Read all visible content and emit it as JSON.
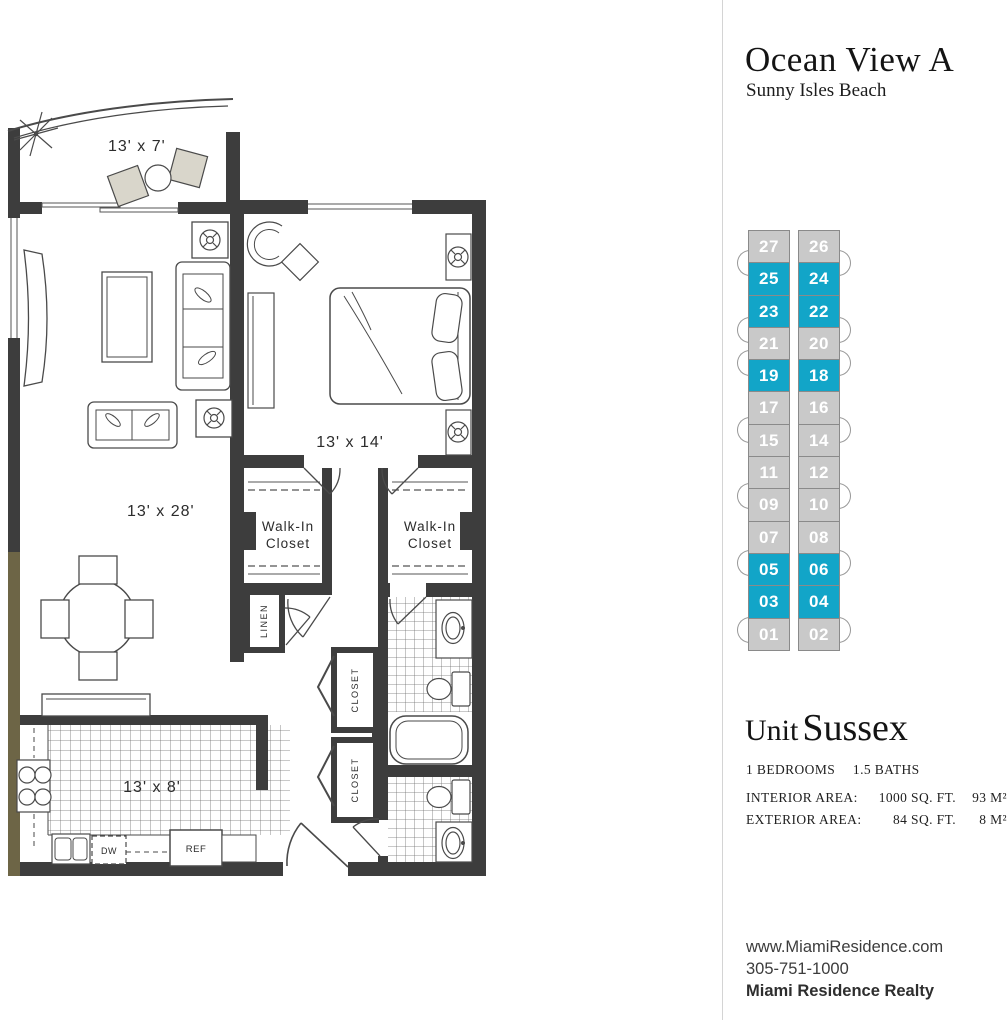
{
  "header": {
    "title": "Ocean View A",
    "subtitle": "Sunny Isles Beach"
  },
  "stack": {
    "left_column": [
      {
        "label": "27",
        "highlight": false
      },
      {
        "label": "25",
        "highlight": true
      },
      {
        "label": "23",
        "highlight": true
      },
      {
        "label": "21",
        "highlight": false
      },
      {
        "label": "19",
        "highlight": true
      },
      {
        "label": "17",
        "highlight": false
      },
      {
        "label": "15",
        "highlight": false
      },
      {
        "label": "11",
        "highlight": false
      },
      {
        "label": "09",
        "highlight": false
      },
      {
        "label": "07",
        "highlight": false
      },
      {
        "label": "05",
        "highlight": true
      },
      {
        "label": "03",
        "highlight": true
      },
      {
        "label": "01",
        "highlight": false
      }
    ],
    "right_column": [
      {
        "label": "26",
        "highlight": false
      },
      {
        "label": "24",
        "highlight": true
      },
      {
        "label": "22",
        "highlight": true
      },
      {
        "label": "20",
        "highlight": false
      },
      {
        "label": "18",
        "highlight": true
      },
      {
        "label": "16",
        "highlight": false
      },
      {
        "label": "14",
        "highlight": false
      },
      {
        "label": "12",
        "highlight": false
      },
      {
        "label": "10",
        "highlight": false
      },
      {
        "label": "08",
        "highlight": false
      },
      {
        "label": "06",
        "highlight": true
      },
      {
        "label": "04",
        "highlight": true
      },
      {
        "label": "02",
        "highlight": false
      }
    ],
    "balcony_tab_boundaries": [
      0,
      2,
      3,
      5,
      7,
      9,
      11
    ],
    "colors": {
      "highlight": "#12a5c8",
      "normal": "#c9c9c9",
      "text": "#ffffff",
      "border": "#8a8a8a"
    }
  },
  "unit": {
    "label": "Unit",
    "name": "Sussex",
    "bedrooms": "1 BEDROOMS",
    "baths": "1.5 BATHS",
    "interior_label": "INTERIOR AREA:",
    "interior_sqft": "1000 SQ. FT.",
    "interior_m2": "93 M²",
    "exterior_label": "EXTERIOR AREA:",
    "exterior_sqft": "84 SQ. FT.",
    "exterior_m2": "8 M²"
  },
  "floorplan": {
    "labels": {
      "balcony": "13' x 7'",
      "living": "13' x 28'",
      "bedroom": "13' x 14'",
      "kitchen": "13' x 8'",
      "walk_in_line1": "Walk-In",
      "walk_in_line2": "Closet",
      "linen": "LINEN",
      "closet": "CLOSET",
      "dishwasher": "DW",
      "refrigerator": "REF"
    }
  },
  "footer": {
    "website": "www.MiamiResidence.com",
    "phone": "305-751-1000",
    "company": "Miami Residence Realty"
  }
}
